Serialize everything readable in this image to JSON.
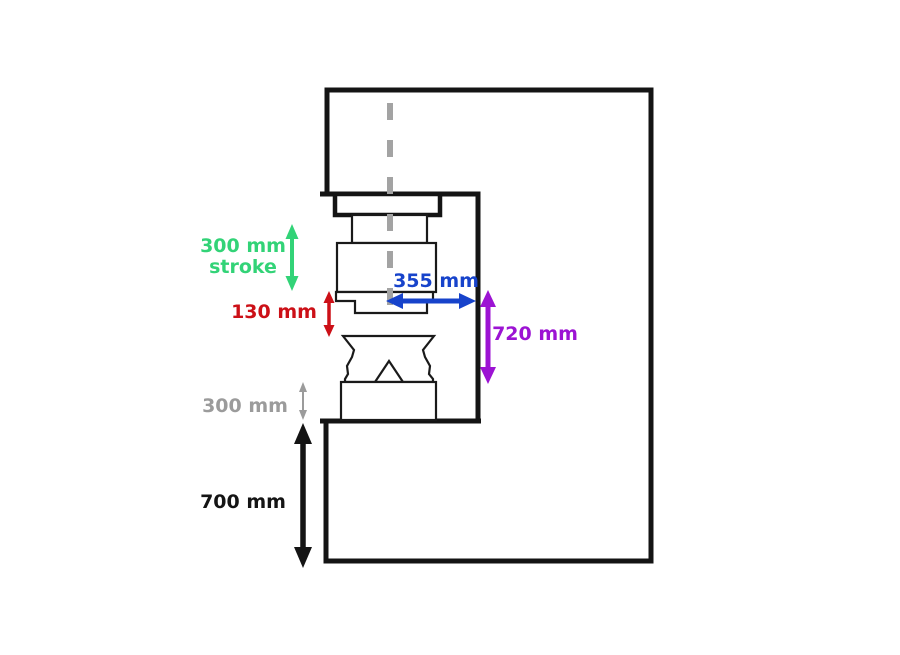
{
  "dimensions": {
    "stroke": {
      "value": "300 mm",
      "caption": "stroke",
      "color": "#32d377"
    },
    "open_gap": {
      "value": "130 mm",
      "color": "#cc1017"
    },
    "throat": {
      "value": "355 mm",
      "color": "#1743cb"
    },
    "daylight": {
      "value": "720 mm",
      "color": "#9c13d3"
    },
    "anvil_height": {
      "value": "300 mm",
      "color": "#9b9b9b"
    },
    "base_height": {
      "value": "700 mm",
      "color": "#141414"
    }
  },
  "colors": {
    "frame_outline": "#141414",
    "part_outline": "#1a1a1a",
    "centerline": "#a3a3a3",
    "background": "#ffffff"
  }
}
